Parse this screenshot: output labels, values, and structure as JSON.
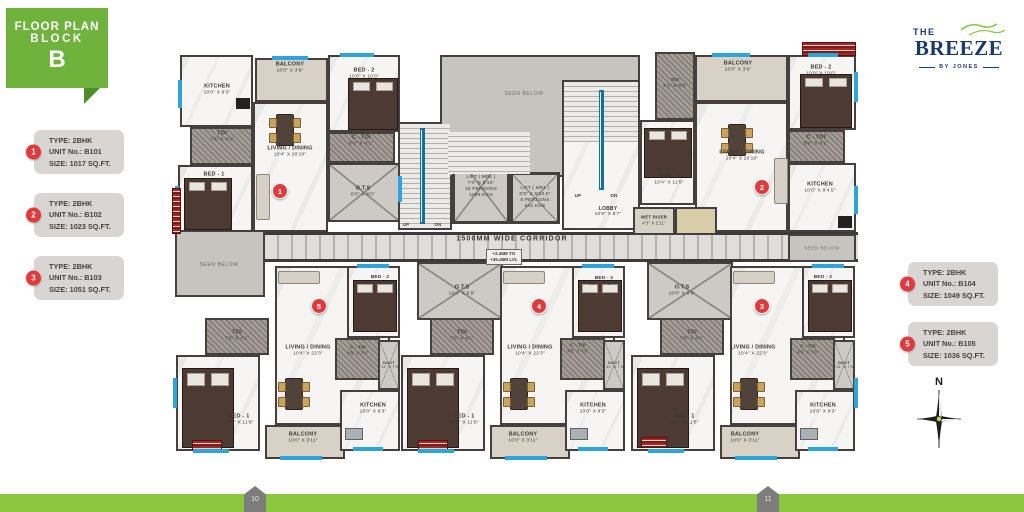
{
  "colors": {
    "brand_green": "#6fb33c",
    "footer_green": "#8cc63f",
    "marker_red": "#df3a3e",
    "logo_navy": "#1b3a69",
    "window_blue": "#2da5da",
    "legend_gray": "#d8d5d2"
  },
  "badge": {
    "line1": "FLOOR PLAN",
    "line2": "BLOCK",
    "line3": "B"
  },
  "logo": {
    "the": "THE",
    "name": "BREEZE",
    "tagline": "BY JONES"
  },
  "legend_left": [
    {
      "num": "1",
      "type": "TYPE: 2BHK",
      "unit": "UNIT No.: B101",
      "size": "SIZE: 1017 SQ.FT."
    },
    {
      "num": "2",
      "type": "TYPE: 2BHK",
      "unit": "UNIT No.: B102",
      "size": "SIZE: 1023 SQ.FT."
    },
    {
      "num": "3",
      "type": "TYPE: 2BHK",
      "unit": "UNIT No.: B103",
      "size": "SIZE: 1051 SQ.FT."
    }
  ],
  "legend_right": [
    {
      "num": "4",
      "type": "TYPE: 2BHK",
      "unit": "UNIT No.: B104",
      "size": "SIZE: 1049 SQ.FT."
    },
    {
      "num": "5",
      "type": "TYPE: 2BHK",
      "unit": "UNIT No.: B105",
      "size": "SIZE: 1036 SQ.FT."
    }
  ],
  "compass": {
    "label": "N"
  },
  "footer": {
    "page_left": "10",
    "page_right": "11"
  },
  "plan": {
    "seen_below": "SEEN BELOW",
    "corridor": {
      "label": "1500MM WIDE CORRIDOR",
      "level1": "+2.45M TO",
      "level2": "+35.45M LVL"
    },
    "core": {
      "lift1": {
        "l1": "LIFT ( MRL )",
        "l2": "7'0\" X 5'10\"",
        "l3": "16 PERSONS",
        "l4": "1088 KGS"
      },
      "lift2": {
        "l1": "LIFT ( MRL )",
        "l2": "6'5\" X 6'10.5\"",
        "l3": "8 PERSONS",
        "l4": "544 KGS"
      },
      "lobby": {
        "name": "LOBBY",
        "dim": "10'8\" X 5'7\""
      },
      "up": "UP",
      "dn": "DN"
    },
    "b101": {
      "marker": "1",
      "kitchen": {
        "name": "KITCHEN",
        "dim": "10'0\" X 8'3\""
      },
      "balcony": {
        "name": "BALCONY",
        "dim": "10'0\" X 3'6\""
      },
      "bed2": {
        "name": "BED - 2",
        "dim": "10'0\" X 10'0\""
      },
      "toi": {
        "name": "TOI",
        "dim": "7'6\" X 4'1\""
      },
      "living": {
        "name": "LIVING / DINING",
        "dim": "10'4\" X 20'10\""
      },
      "bed1": {
        "name": "BED - 1",
        "dim": "10'0\" X 10'2\""
      },
      "ctoi": {
        "name": "C - TOI",
        "dim": "8'0\" X 4'1\""
      },
      "ots": {
        "name": "O.T.S",
        "dim": "8'0\" X 8'0\""
      }
    },
    "b102": {
      "marker": "2",
      "toi": {
        "name": "TOI",
        "dim": "4'1\" X 8'0\""
      },
      "balcony": {
        "name": "BALCONY",
        "dim": "10'0\" X 3'6\""
      },
      "bed2": {
        "name": "BED - 2",
        "dim": "10'0\" X 10'0\""
      },
      "living": {
        "name": "LIVING / DINING",
        "dim": "10'4\" X 20'10\""
      },
      "bed1": {
        "name": "BED - 1",
        "dim": "10'4\" X 11'8\""
      },
      "ctoi": {
        "name": "C - TOI",
        "dim": "8'0\" X 4'1\""
      },
      "kitchen": {
        "name": "KITCHEN",
        "dim": "10'0\" X 8'4.5\""
      },
      "wet_riser": {
        "name": "WET RISER",
        "dim": "4'3\" X 2'11\""
      }
    },
    "b105": {
      "marker": "5",
      "toi": {
        "name": "TOI",
        "dim": "7'6\" X 4'1\""
      },
      "living": {
        "name": "LIVING / DINING",
        "dim": "10'4\" X 22'3\""
      },
      "bed1": {
        "name": "BED - 1",
        "dim": "10'0\" X 11'8\""
      },
      "bed2": {
        "name": "BED - 2",
        "dim": "10'0\" X 10'0\""
      },
      "ctoi": {
        "name": "C - TOI",
        "dim": "4'5\" X 7'6\""
      },
      "duct": {
        "name": "DUCT",
        "dim": "4'11\" X 7'0\""
      },
      "kitchen": {
        "name": "KITCHEN",
        "dim": "10'0\" X 8'3\""
      },
      "balcony": {
        "name": "BALCONY",
        "dim": "10'0\" X 3'11\""
      }
    },
    "b104": {
      "marker": "4",
      "ots": {
        "name": "O.T.S",
        "dim": "10'0\" X 6'9\""
      },
      "toi": {
        "name": "TOI",
        "dim": "7'6\" X 4'1\""
      },
      "living": {
        "name": "LIVING / DINING",
        "dim": "10'4\" X 22'3\""
      },
      "bed1": {
        "name": "BED - 1",
        "dim": "10'0\" X 11'8\""
      },
      "bed2": {
        "name": "BED - 2",
        "dim": "10'0\" X 10'0\""
      },
      "ctoi": {
        "name": "C - TOI",
        "dim": "4'5\" X 7'6\""
      },
      "duct": {
        "name": "DUCT",
        "dim": "4'11\" X 7'0\""
      },
      "kitchen": {
        "name": "KITCHEN",
        "dim": "10'0\" X 8'3\""
      },
      "balcony": {
        "name": "BALCONY",
        "dim": "10'0\" X 3'11\""
      }
    },
    "b103": {
      "marker": "3",
      "ots": {
        "name": "O.T.S",
        "dim": "10'0\" X 6'9\""
      },
      "toi": {
        "name": "TOI",
        "dim": "7'6\" X 4'1\""
      },
      "living": {
        "name": "LIVING / DINING",
        "dim": "10'4\" X 22'3\""
      },
      "bed1": {
        "name": "BED - 1",
        "dim": "10'0\" X 11'8\""
      },
      "bed2": {
        "name": "BED - 2",
        "dim": "10'0\" X 10'0\""
      },
      "ctoi": {
        "name": "C - TOI",
        "dim": "4'5\" X 7'6\""
      },
      "duct": {
        "name": "DUCT",
        "dim": "4'11\" X 7'0\""
      },
      "kitchen": {
        "name": "KITCHEN",
        "dim": "10'0\" X 8'3\""
      },
      "balcony": {
        "name": "BALCONY",
        "dim": "10'0\" X 3'11\""
      }
    }
  }
}
